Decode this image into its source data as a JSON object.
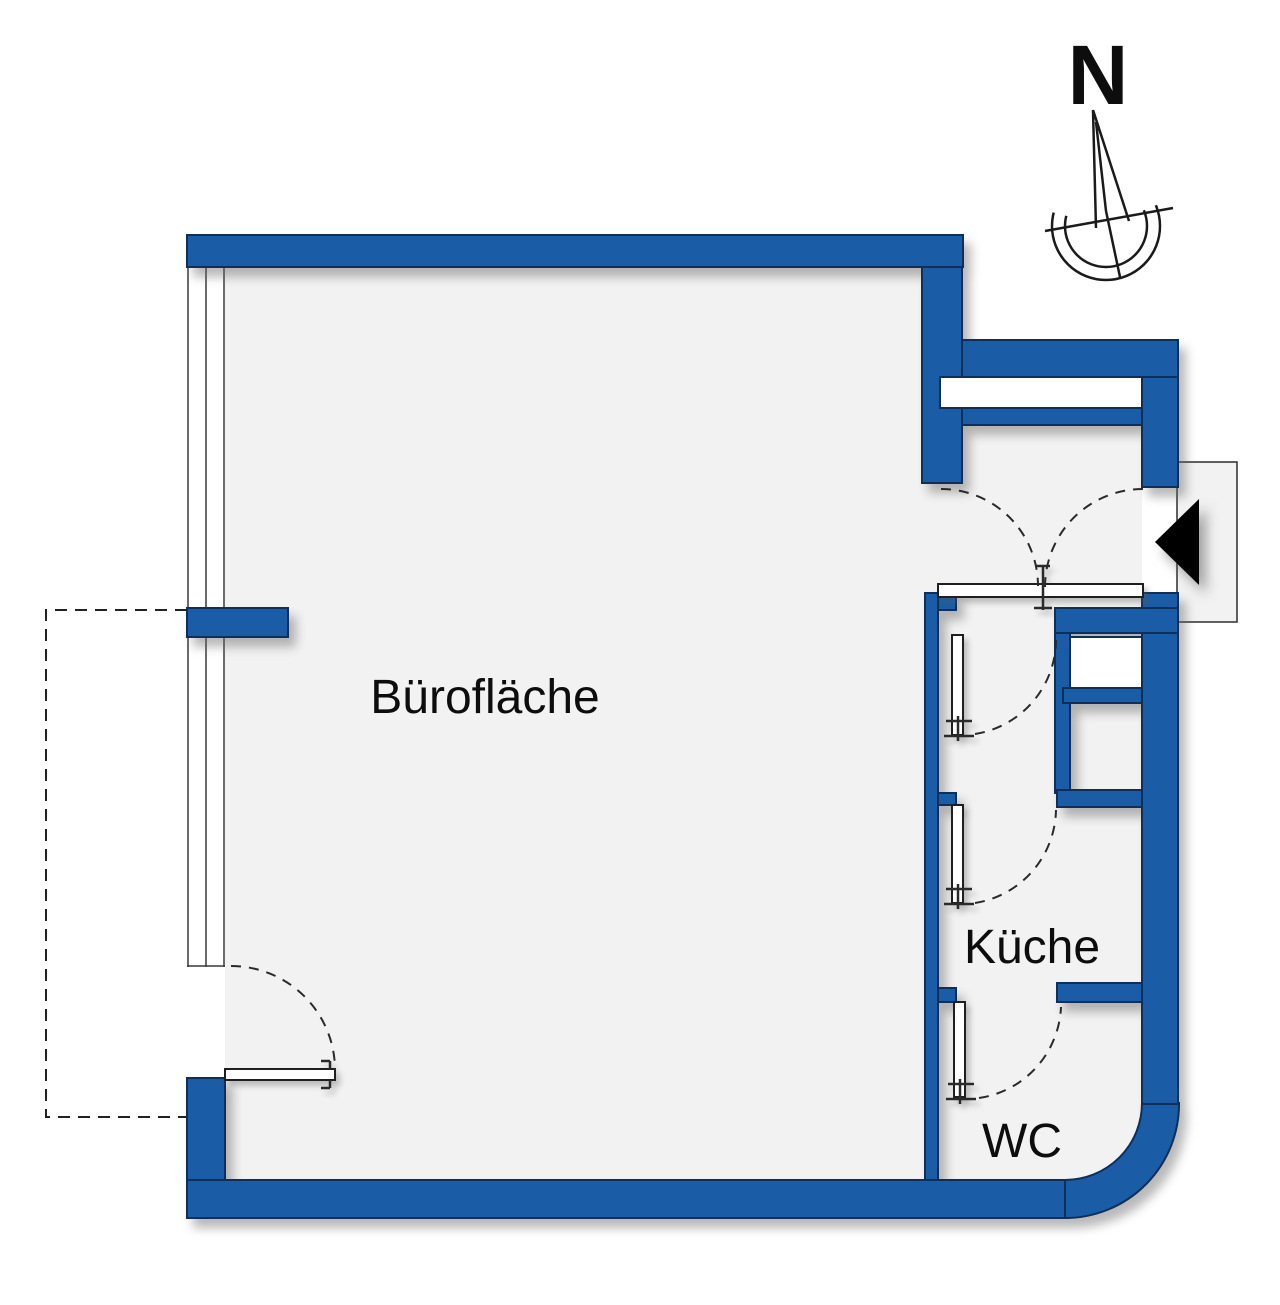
{
  "plan": {
    "type": "floor-plan",
    "labels": {
      "office": "Bürofläche",
      "kitchen": "Küche",
      "wc": "WC",
      "north": "N"
    },
    "icons": {
      "north_compass": "north-compass-icon",
      "entrance_arrow": "entrance-arrow-icon"
    },
    "colors": {
      "wall_blue": "#1a5da6",
      "wall_outline": "#0e2f5a",
      "floor_gray": "#f2f2f2",
      "line_dark": "#222222",
      "arrow_black": "#000000",
      "background": "#ffffff"
    }
  }
}
